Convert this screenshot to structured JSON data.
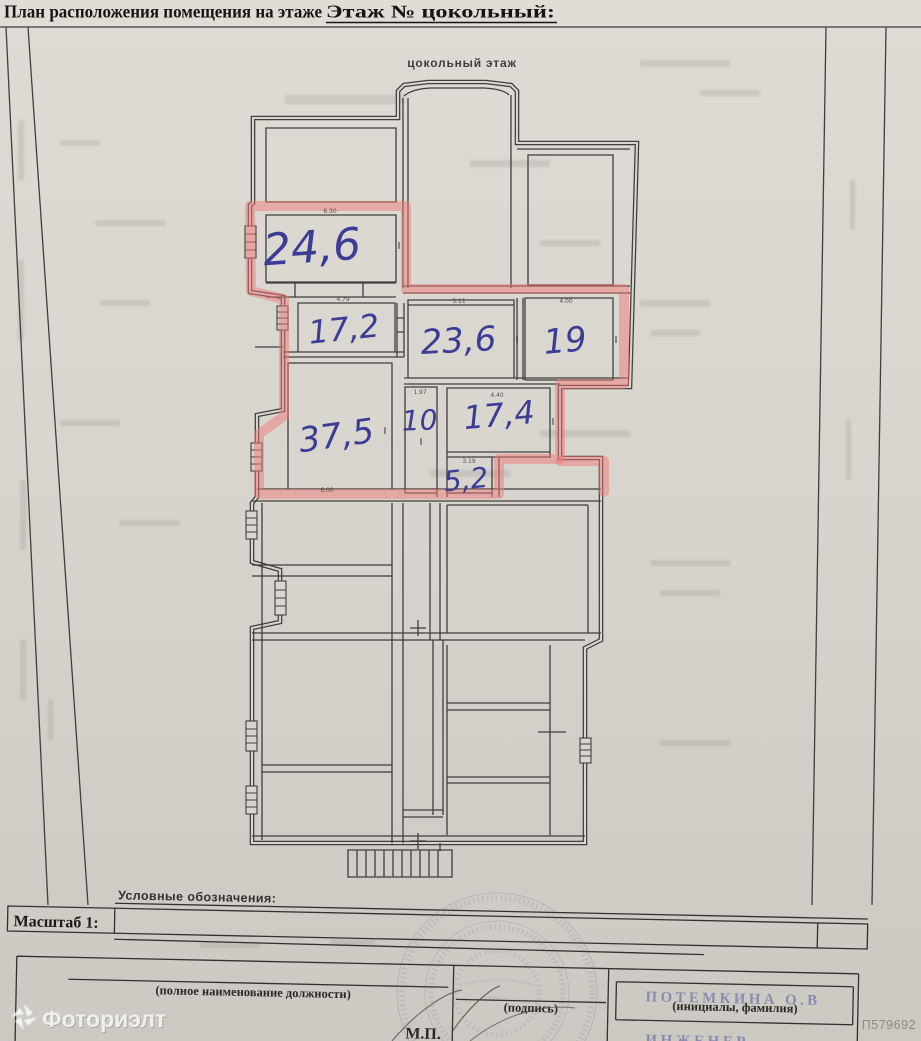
{
  "header": {
    "title": "План расположения помещения на этаже",
    "floor_label": "Этаж № цокольный:"
  },
  "plan": {
    "caption": "цокольный этаж",
    "rooms": [
      {
        "area": "24,6"
      },
      {
        "area": "17,2"
      },
      {
        "area": "23,6"
      },
      {
        "area": "19"
      },
      {
        "area": "37,5"
      },
      {
        "area": "10"
      },
      {
        "area": "17,4"
      },
      {
        "area": "5,2"
      }
    ],
    "dimensions": {
      "room24_width": "6.30",
      "room17_2_width": "4.79",
      "room23_6_width": "5.11",
      "room19_width": "4.00",
      "room10_width": "1.97",
      "room17_4_width": "4.40",
      "room5_2_width": "3.19",
      "room37_5_width": "6.00"
    }
  },
  "legend_label": "Условные обозначения:",
  "scale_label": "Масштаб 1:",
  "signature": {
    "position_label": "(полное наименование должности)",
    "sign_label": "(подпись)",
    "initials_label": "(инициалы, фамилия)",
    "mp_label": "М.П."
  },
  "stamp_overlay": {
    "name": "ПОТЕМКИНА О.В",
    "role": "ИНЖЕНЕР"
  },
  "watermark_text": "Фоториэлт",
  "photo_id": "П579692",
  "colors": {
    "highlight": "#ef7b79",
    "ink": "#3c3c96",
    "paper": "#d8d5ce",
    "wall": "#413f3b"
  }
}
